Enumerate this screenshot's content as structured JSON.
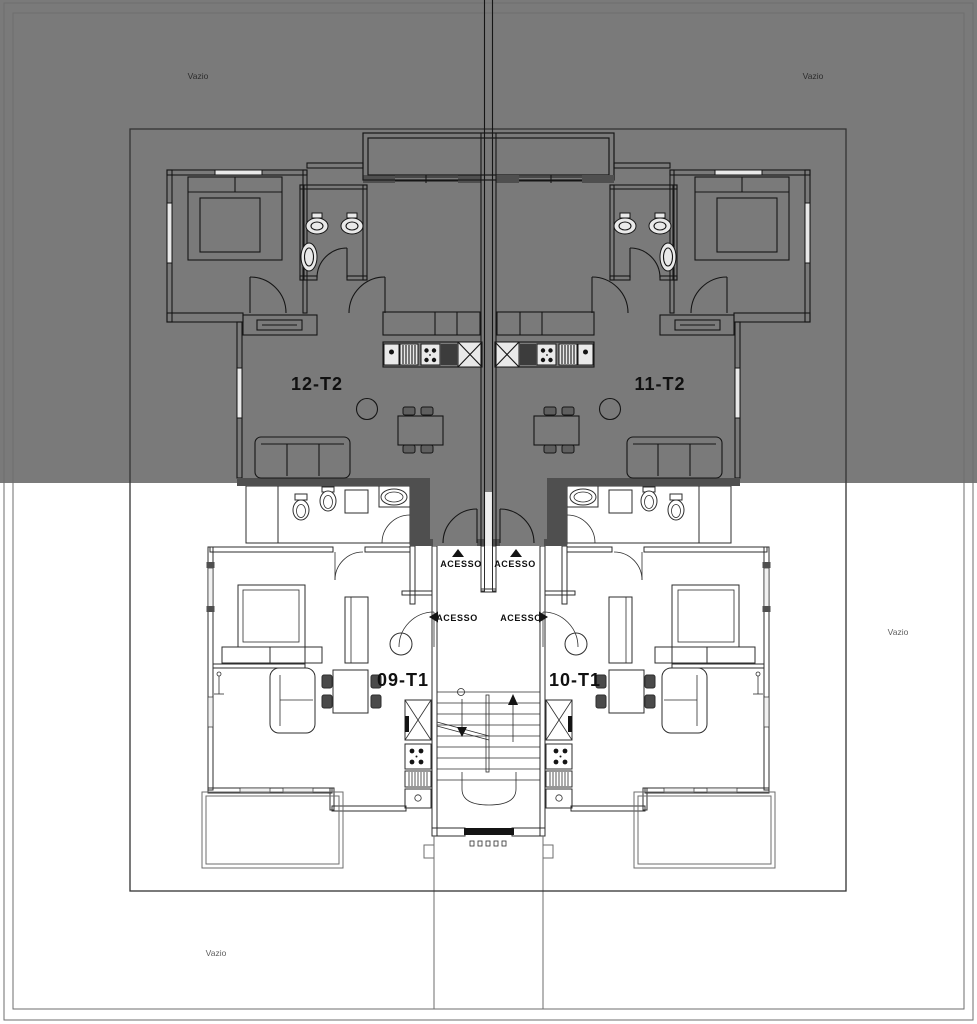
{
  "plan": {
    "kind": "residential-floor-plan",
    "upper_floor": {
      "unit_left": {
        "label": "12-T2"
      },
      "unit_right": {
        "label": "11-T2"
      },
      "vazio_top_left": "Vazio",
      "vazio_top_right": "Vazio"
    },
    "lower_floor": {
      "unit_left": {
        "label": "09-T1"
      },
      "unit_right": {
        "label": "10-T1"
      },
      "vazio_right": "Vazio",
      "vazio_bottom_left": "Vazio"
    },
    "access": {
      "upper_left": {
        "label": "ACESSO",
        "direction": "up"
      },
      "upper_right": {
        "label": "ACESSO",
        "direction": "up"
      },
      "mid_left": {
        "label": "ACESSO",
        "direction": "left"
      },
      "mid_right": {
        "label": "ACESSO",
        "direction": "right"
      }
    }
  },
  "colors": {
    "upper_overlay": "#7a7a7a",
    "background": "#ffffff",
    "wall_dark": "#4f4f4f",
    "line_dark": "#1f1f1f",
    "border": "#6e6e6e"
  }
}
